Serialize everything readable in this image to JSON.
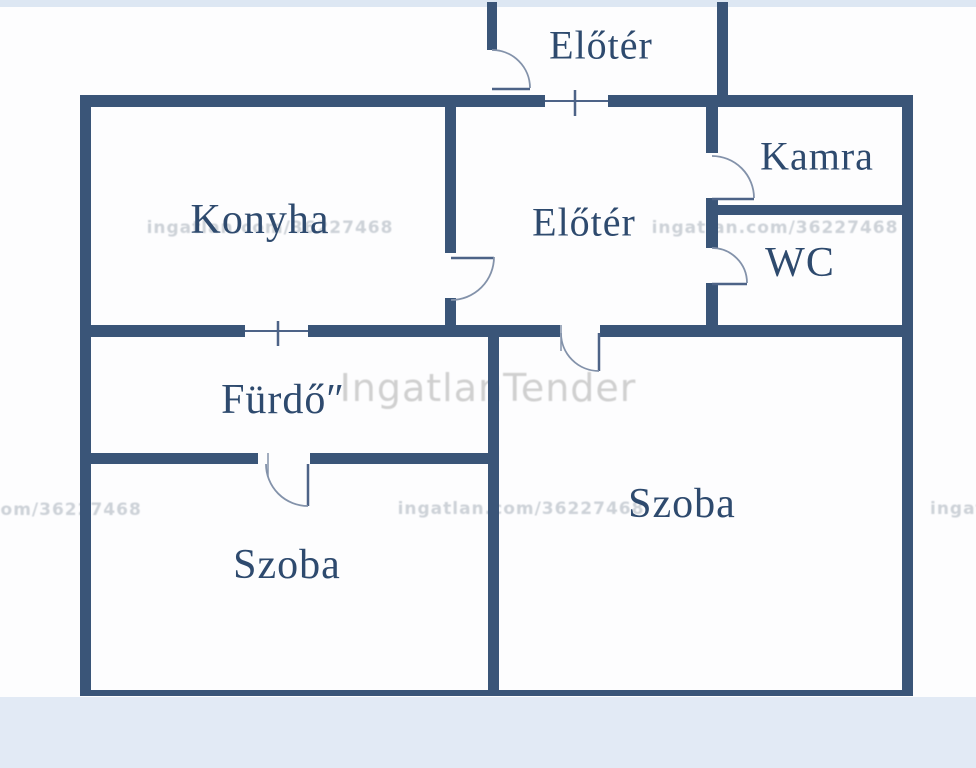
{
  "plan_title": "apartment floor plan",
  "rooms": [
    {
      "id": "vestibule",
      "label": "Előtér"
    },
    {
      "id": "kitchen",
      "label": "Konyha"
    },
    {
      "id": "hall",
      "label": "Előtér"
    },
    {
      "id": "pantry",
      "label": "Kamra"
    },
    {
      "id": "wc",
      "label": "WC"
    },
    {
      "id": "bathroom",
      "label": "Fürdő″"
    },
    {
      "id": "room-left",
      "label": "Szoba"
    },
    {
      "id": "room-right",
      "label": "Szoba"
    }
  ],
  "watermarks": {
    "brand": "IngatlanTender",
    "listing": "ingatlan.com/36227468",
    "listing_partial_left": ".com/36227468",
    "listing_partial_right": "ingatlan.c"
  },
  "colors": {
    "wall": "#3a5578",
    "label": "#2e4a6e",
    "door_line": "#4d6387",
    "door_arc": "#8392aa",
    "top_band": "#dde7f3",
    "bottom_band": "#e2eaf5",
    "watermark": "#cdd2d8",
    "watermark_big": "#d0d0d0",
    "paper": "#fdfdfe"
  }
}
